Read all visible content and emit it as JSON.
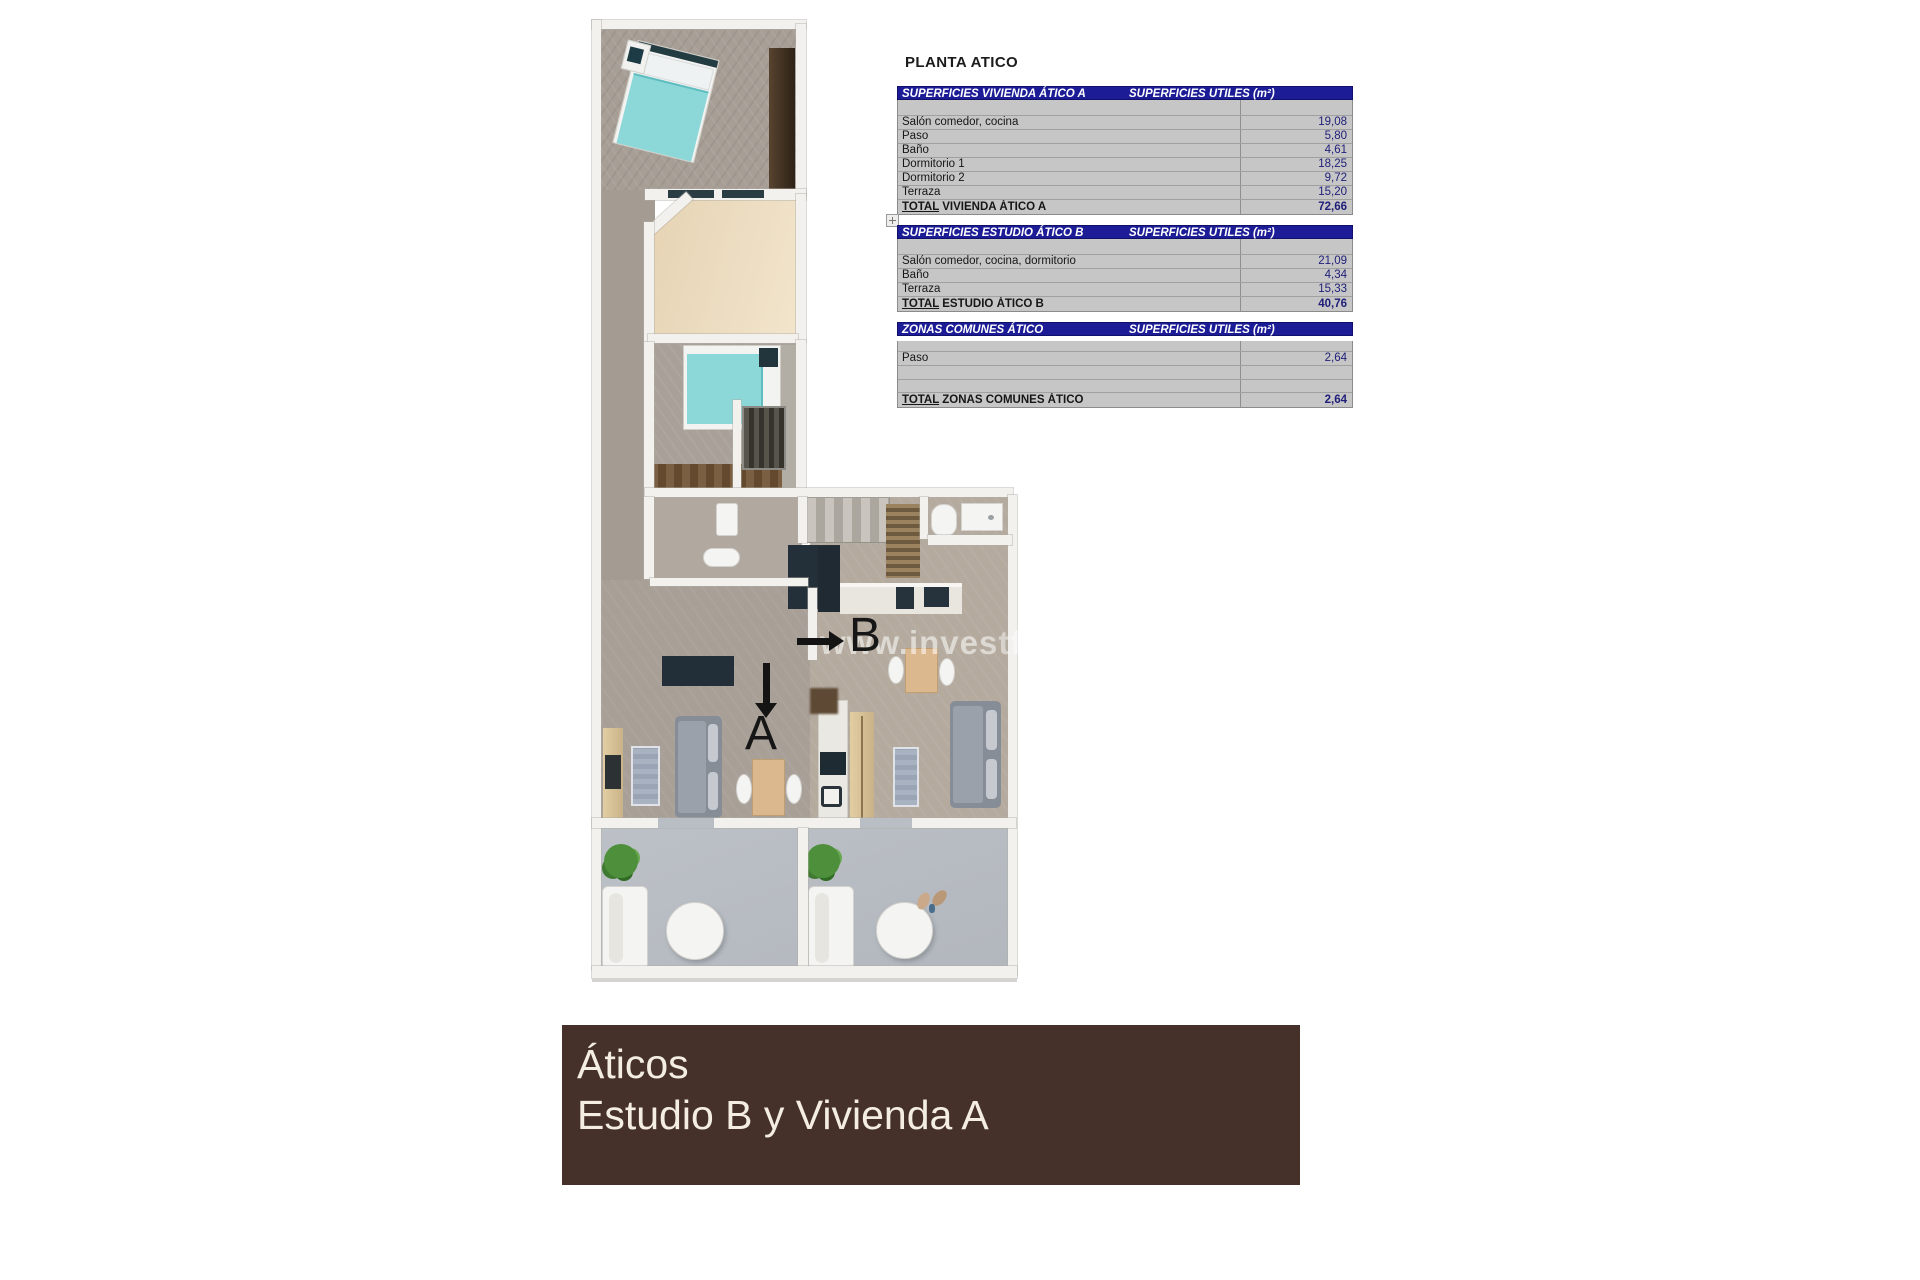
{
  "title": "PLANTA ATICO",
  "tables": [
    {
      "header_left": "SUPERFICIES VIVIENDA ÁTICO A",
      "header_right": "SUPERFICIES UTILES  (m²)",
      "rows": [
        {
          "label": "Salón comedor, cocina",
          "value": "19,08"
        },
        {
          "label": "Paso",
          "value": "5,80"
        },
        {
          "label": "Baño",
          "value": "4,61"
        },
        {
          "label": "Dormitorio 1",
          "value": "18,25"
        },
        {
          "label": "Dormitorio 2",
          "value": "9,72"
        },
        {
          "label": "Terraza",
          "value": "15,20"
        }
      ],
      "total_word": "TOTAL",
      "total_rest": " VIVIENDA ÁTICO A",
      "total_value": "72,66"
    },
    {
      "header_left": "SUPERFICIES ESTUDIO ÁTICO B",
      "header_right": "SUPERFICIES UTILES  (m²)",
      "rows": [
        {
          "label": "Salón comedor, cocina, dormitorio",
          "value": "21,09"
        },
        {
          "label": "Baño",
          "value": "4,34"
        },
        {
          "label": "Terraza",
          "value": "15,33"
        }
      ],
      "total_word": "TOTAL",
      "total_rest": " ESTUDIO ÁTICO B",
      "total_value": "40,76"
    },
    {
      "header_left": "ZONAS COMUNES ÁTICO",
      "header_right": "SUPERFICIES UTILES  (m²)",
      "rows": [
        {
          "label": "Paso",
          "value": "2,64"
        }
      ],
      "total_word": "TOTAL",
      "total_rest": " ZONAS COMUNES ÁTICO",
      "total_value": "2,64"
    }
  ],
  "plan": {
    "label_a": "A",
    "label_b": "B",
    "watermark": "www.investforhomes"
  },
  "banner": {
    "line1": "Áticos",
    "line2": "Estudio B y Vivienda A",
    "background": "#46302a",
    "text_color": "#f4ede1"
  },
  "colors": {
    "table_header_bg": "#1c1c96",
    "table_body_bg": "#c6c6c6",
    "value_text": "#20207a",
    "bed_turquoise": "#8cd8d9",
    "terrace_floor": "#b9bec4",
    "wood_brown": "#5a4632"
  }
}
